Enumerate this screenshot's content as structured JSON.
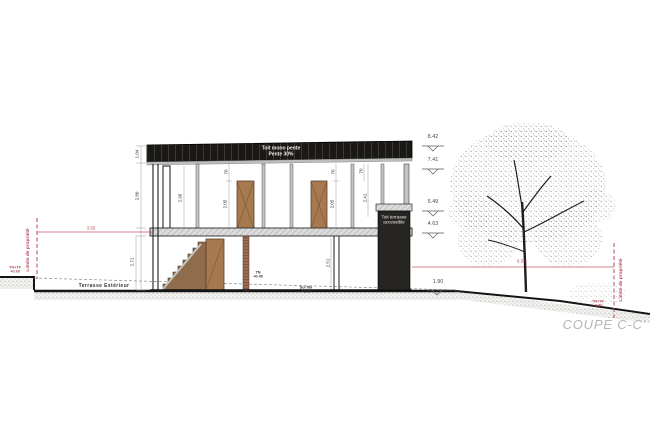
{
  "title": "COUPE C-C'",
  "roof": {
    "line1": "Toit mono pente",
    "line2": "Pente 30%"
  },
  "terrace_box": {
    "line1": "Toit terrasse",
    "line2": "accessible"
  },
  "levels": {
    "roof_top": "8.42",
    "roof_eave": "7.41",
    "terrace_top": "5.49",
    "terrace_slab": "4.63",
    "ground": "1.90"
  },
  "dims": {
    "roof_height": "1.04",
    "upper_height": "2.80",
    "upper_interior": "2.96",
    "lintel_a": "70",
    "door_a": "2.05",
    "lintel_b": "70",
    "door_b": "2.05",
    "lintel_c": "70",
    "right_interior": "2.41",
    "lower_height": "2.71",
    "lower_interior": "2.51"
  },
  "left_boundary": {
    "label": "Limite de propriété",
    "tn1": "TN+TF",
    "tn2": "+0.60",
    "setback": "3.55"
  },
  "right_boundary": {
    "label": "Limite de propriété",
    "tn1": "TN+TF",
    "tn2": "-0.90",
    "distance": "6.5m"
  },
  "ground_labels": {
    "terrace": "Terrasse Extérieur",
    "tn1": "TN",
    "tn2": "+0.40",
    "sol1": "Sol fini",
    "sol2": "+0.10"
  },
  "colors": {
    "accent_red": "#b5485c",
    "roof_black": "#1b1916",
    "door_brown": "#a67a4e",
    "title_gray": "#b6b6b6"
  }
}
